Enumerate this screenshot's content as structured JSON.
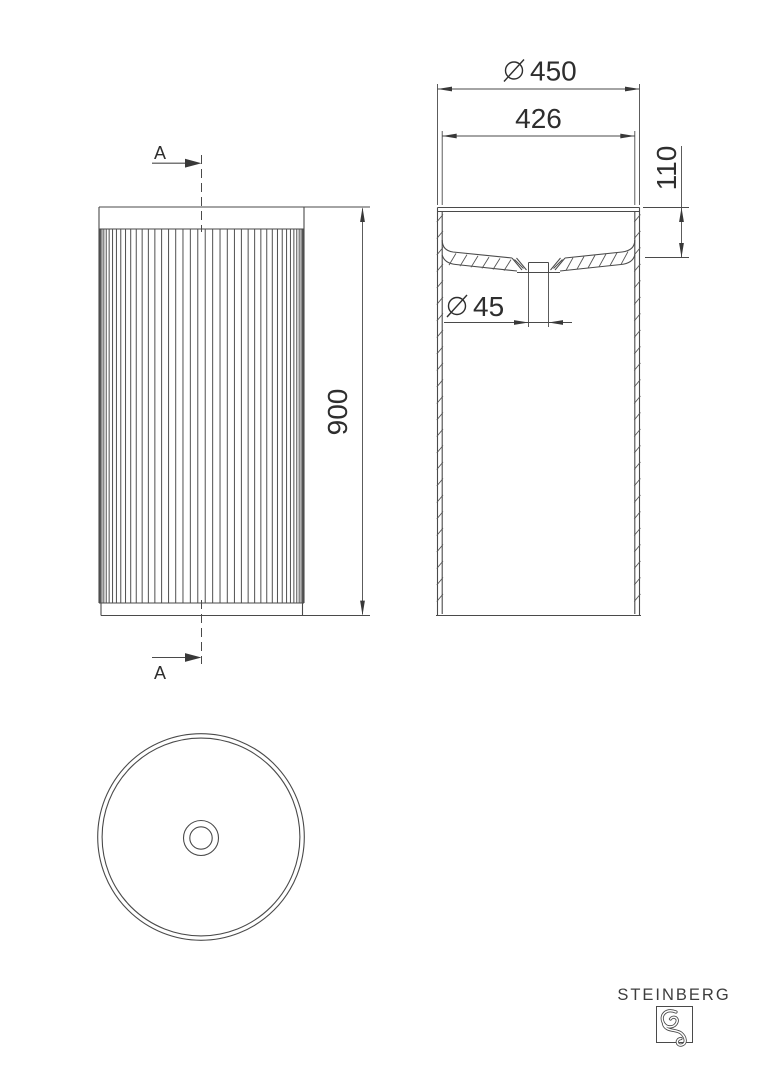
{
  "colors": {
    "background": "#ffffff",
    "line": "#4a4a4a",
    "text": "#2e2e2e",
    "arrow": "#383838"
  },
  "front_view": {
    "section_label_top": "A",
    "section_label_bottom": "A",
    "dim_height": "900"
  },
  "section_view": {
    "diameter_symbol": "Ø",
    "dim_outer_diameter": "450",
    "dim_inner_diameter": "426",
    "dim_depth": "110",
    "dim_drain_diameter": "45"
  },
  "branding": {
    "logo_text": "STEINBERG"
  }
}
